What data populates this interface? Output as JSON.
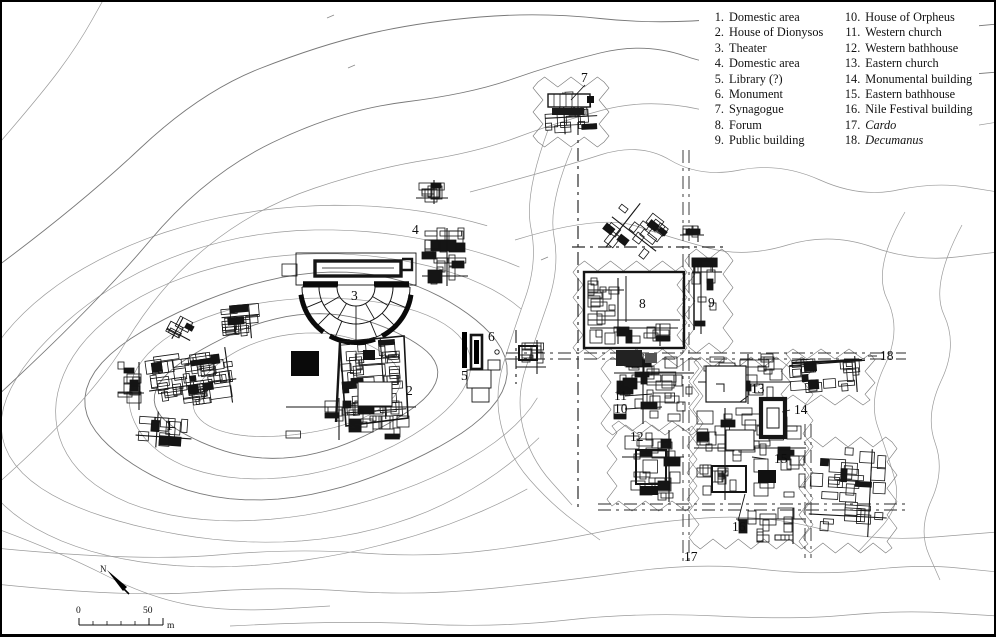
{
  "figure": {
    "type": "archaeological-site-plan",
    "colors": {
      "ink": "#151515",
      "contour": "#9a9a9a",
      "contour_dark": "#787878",
      "paper": "#ffffff"
    }
  },
  "legend": {
    "columns": [
      {
        "items": [
          {
            "num": "1.",
            "label": "Domestic area",
            "italic": false
          },
          {
            "num": "2.",
            "label": "House of Dionysos",
            "italic": false
          },
          {
            "num": "3.",
            "label": "Theater",
            "italic": false
          },
          {
            "num": "4.",
            "label": "Domestic area",
            "italic": false
          },
          {
            "num": "5.",
            "label": "Library (?)",
            "italic": false
          },
          {
            "num": "6.",
            "label": "Monument",
            "italic": false
          },
          {
            "num": "7.",
            "label": "Synagogue",
            "italic": false
          },
          {
            "num": "8.",
            "label": "Forum",
            "italic": false
          },
          {
            "num": "9.",
            "label": "Public building",
            "italic": false
          }
        ]
      },
      {
        "items": [
          {
            "num": "10.",
            "label": "House of Orpheus",
            "italic": false
          },
          {
            "num": "11.",
            "label": "Western church",
            "italic": false
          },
          {
            "num": "12.",
            "label": "Western bathhouse",
            "italic": false
          },
          {
            "num": "13.",
            "label": "Eastern church",
            "italic": false
          },
          {
            "num": "14.",
            "label": "Monumental building",
            "italic": false
          },
          {
            "num": "15.",
            "label": "Eastern bathhouse",
            "italic": false
          },
          {
            "num": "16.",
            "label": "Nile Festival building",
            "italic": false
          },
          {
            "num": "17.",
            "label": "Cardo",
            "italic": true
          },
          {
            "num": "18.",
            "label": "Decumanus",
            "italic": true
          }
        ]
      }
    ]
  },
  "map_labels": [
    {
      "n": "1",
      "x": 166,
      "y": 430
    },
    {
      "n": "2",
      "x": 406,
      "y": 395
    },
    {
      "n": "3",
      "x": 351,
      "y": 300
    },
    {
      "n": "4",
      "x": 412,
      "y": 234
    },
    {
      "n": "5",
      "x": 461,
      "y": 380
    },
    {
      "n": "6",
      "x": 488,
      "y": 341
    },
    {
      "n": "7",
      "x": 581,
      "y": 82
    },
    {
      "n": "8",
      "x": 639,
      "y": 308
    },
    {
      "n": "9",
      "x": 708,
      "y": 307
    },
    {
      "n": "10",
      "x": 614,
      "y": 413
    },
    {
      "n": "11",
      "x": 614,
      "y": 400
    },
    {
      "n": "12",
      "x": 630,
      "y": 441
    },
    {
      "n": "13",
      "x": 751,
      "y": 393
    },
    {
      "n": "14",
      "x": 794,
      "y": 414
    },
    {
      "n": "15",
      "x": 774,
      "y": 463
    },
    {
      "n": "16",
      "x": 732,
      "y": 531
    },
    {
      "n": "17",
      "x": 684,
      "y": 561
    },
    {
      "n": "18",
      "x": 880,
      "y": 360
    }
  ],
  "leader_lines": [
    {
      "x1": 585,
      "y1": 85,
      "x2": 571,
      "y2": 100
    },
    {
      "x1": 625,
      "y1": 396,
      "x2": 652,
      "y2": 394
    },
    {
      "x1": 625,
      "y1": 409,
      "x2": 662,
      "y2": 407
    },
    {
      "x1": 748,
      "y1": 396,
      "x2": 740,
      "y2": 402
    },
    {
      "x1": 790,
      "y1": 410,
      "x2": 782,
      "y2": 412
    },
    {
      "x1": 766,
      "y1": 459,
      "x2": 752,
      "y2": 457
    },
    {
      "x1": 738,
      "y1": 521,
      "x2": 745,
      "y2": 494
    },
    {
      "x1": 868,
      "y1": 356,
      "x2": 877,
      "y2": 356
    }
  ],
  "streets": [
    {
      "name": "synagogue-street",
      "x1": 578,
      "y1": 96,
      "x2": 578,
      "y2": 510,
      "double": false
    },
    {
      "name": "cardo",
      "x1": 686,
      "y1": 150,
      "x2": 686,
      "y2": 562,
      "double": true
    },
    {
      "name": "decumanus",
      "x1": 506,
      "y1": 356,
      "x2": 906,
      "y2": 356,
      "double": true
    },
    {
      "name": "north-cross-street",
      "x1": 572,
      "y1": 247,
      "x2": 726,
      "y2": 247,
      "double": false
    },
    {
      "name": "south-cross-street",
      "x1": 598,
      "y1": 507,
      "x2": 908,
      "y2": 507,
      "double": true
    },
    {
      "name": "east-street",
      "x1": 808,
      "y1": 424,
      "x2": 808,
      "y2": 558,
      "double": true
    },
    {
      "name": "west-stub-street",
      "x1": 516,
      "y1": 330,
      "x2": 516,
      "y2": 384,
      "double": false
    }
  ],
  "excavation_areas": [
    {
      "name": "synagogue-area",
      "pts": [
        [
          538,
          82
        ],
        [
          604,
          82
        ],
        [
          604,
          142
        ],
        [
          538,
          142
        ]
      ]
    },
    {
      "name": "forum-area",
      "pts": [
        [
          578,
          266
        ],
        [
          682,
          266
        ],
        [
          682,
          354
        ],
        [
          578,
          354
        ]
      ]
    },
    {
      "name": "area-9",
      "pts": [
        [
          690,
          254
        ],
        [
          728,
          254
        ],
        [
          728,
          348
        ],
        [
          690,
          348
        ]
      ]
    },
    {
      "name": "orpheus-area",
      "pts": [
        [
          606,
          362
        ],
        [
          698,
          362
        ],
        [
          698,
          430
        ],
        [
          606,
          430
        ]
      ]
    },
    {
      "name": "bathhouse-12-area",
      "pts": [
        [
          612,
          426
        ],
        [
          692,
          426
        ],
        [
          692,
          506
        ],
        [
          612,
          506
        ]
      ]
    },
    {
      "name": "east-area",
      "pts": [
        [
          694,
          362
        ],
        [
          808,
          362
        ],
        [
          808,
          544
        ],
        [
          694,
          544
        ]
      ]
    },
    {
      "name": "ne-area",
      "pts": [
        [
          786,
          354
        ],
        [
          870,
          354
        ],
        [
          870,
          400
        ],
        [
          786,
          400
        ]
      ]
    },
    {
      "name": "se-area",
      "pts": [
        [
          804,
          442
        ],
        [
          892,
          442
        ],
        [
          892,
          548
        ],
        [
          804,
          548
        ]
      ]
    }
  ],
  "clusters": [
    {
      "name": "domestic-area-1-main",
      "x": 148,
      "y": 352,
      "w": 88,
      "h": 56,
      "rot": -8,
      "rooms": 52,
      "seed": 11
    },
    {
      "name": "domestic-area-1-ne",
      "x": 222,
      "y": 305,
      "w": 38,
      "h": 34,
      "rot": -5,
      "rooms": 14,
      "seed": 2
    },
    {
      "name": "domestic-area-1-w",
      "x": 118,
      "y": 362,
      "w": 26,
      "h": 48,
      "rot": 0,
      "rooms": 10,
      "seed": 3
    },
    {
      "name": "domestic-area-1-s",
      "x": 136,
      "y": 412,
      "w": 56,
      "h": 36,
      "rot": 4,
      "rooms": 10,
      "seed": 4
    },
    {
      "name": "domestic-area-1-sq",
      "x": 168,
      "y": 318,
      "w": 26,
      "h": 24,
      "rot": 28,
      "rooms": 5,
      "seed": 5
    },
    {
      "name": "house-of-dionysos",
      "x": 342,
      "y": 338,
      "w": 62,
      "h": 82,
      "rot": -4,
      "rooms": 38,
      "seed": 6
    },
    {
      "name": "south-range",
      "x": 286,
      "y": 398,
      "w": 130,
      "h": 42,
      "rot": 0,
      "rooms": 24,
      "seed": 7
    },
    {
      "name": "domestic-area-4",
      "x": 422,
      "y": 228,
      "w": 46,
      "h": 58,
      "rot": 0,
      "rooms": 24,
      "seed": 8
    },
    {
      "name": "area-4-north",
      "x": 416,
      "y": 180,
      "w": 32,
      "h": 24,
      "rot": 0,
      "rooms": 9,
      "seed": 9
    },
    {
      "name": "synagogue",
      "x": 545,
      "y": 92,
      "w": 52,
      "h": 42,
      "rot": -3,
      "rooms": 16,
      "seed": 10
    },
    {
      "name": "north-of-forum",
      "x": 606,
      "y": 206,
      "w": 56,
      "h": 56,
      "rot": 38,
      "rooms": 16,
      "seed": 12
    },
    {
      "name": "public-building-9",
      "x": 692,
      "y": 258,
      "w": 30,
      "h": 76,
      "rot": 0,
      "rooms": 10,
      "seed": 13
    },
    {
      "name": "ne-bits-9",
      "x": 680,
      "y": 226,
      "w": 24,
      "h": 16,
      "rot": 0,
      "rooms": 4,
      "seed": 14
    },
    {
      "name": "forum-west-range",
      "x": 588,
      "y": 278,
      "w": 36,
      "h": 66,
      "rot": 0,
      "rooms": 14,
      "seed": 22
    },
    {
      "name": "forum-south-range",
      "x": 590,
      "y": 324,
      "w": 88,
      "h": 22,
      "rot": 0,
      "rooms": 12,
      "seed": 23
    },
    {
      "name": "orpheus-west-church",
      "x": 614,
      "y": 354,
      "w": 80,
      "h": 70,
      "rot": 0,
      "rooms": 34,
      "seed": 15
    },
    {
      "name": "western-bathhouse",
      "x": 622,
      "y": 430,
      "w": 62,
      "h": 72,
      "rot": 0,
      "rooms": 24,
      "seed": 16
    },
    {
      "name": "eastern-church-area",
      "x": 698,
      "y": 354,
      "w": 92,
      "h": 50,
      "rot": 0,
      "rooms": 18,
      "seed": 17
    },
    {
      "name": "nile-festival-area",
      "x": 694,
      "y": 408,
      "w": 112,
      "h": 92,
      "rot": 0,
      "rooms": 48,
      "seed": 18
    },
    {
      "name": "south-strip",
      "x": 736,
      "y": 508,
      "w": 70,
      "h": 36,
      "rot": 0,
      "rooms": 13,
      "seed": 24
    },
    {
      "name": "ne-cluster",
      "x": 790,
      "y": 358,
      "w": 76,
      "h": 36,
      "rot": -4,
      "rooms": 20,
      "seed": 19
    },
    {
      "name": "se-cluster",
      "x": 810,
      "y": 448,
      "w": 78,
      "h": 88,
      "rot": 3,
      "rooms": 28,
      "seed": 20
    },
    {
      "name": "decumanus-west-buildings",
      "x": 516,
      "y": 340,
      "w": 30,
      "h": 34,
      "rot": 0,
      "rooms": 7,
      "seed": 21
    }
  ],
  "scale_bar": {
    "start_label": "0",
    "end_label": "50",
    "unit": "m"
  },
  "north_arrow": {
    "label": "N"
  }
}
